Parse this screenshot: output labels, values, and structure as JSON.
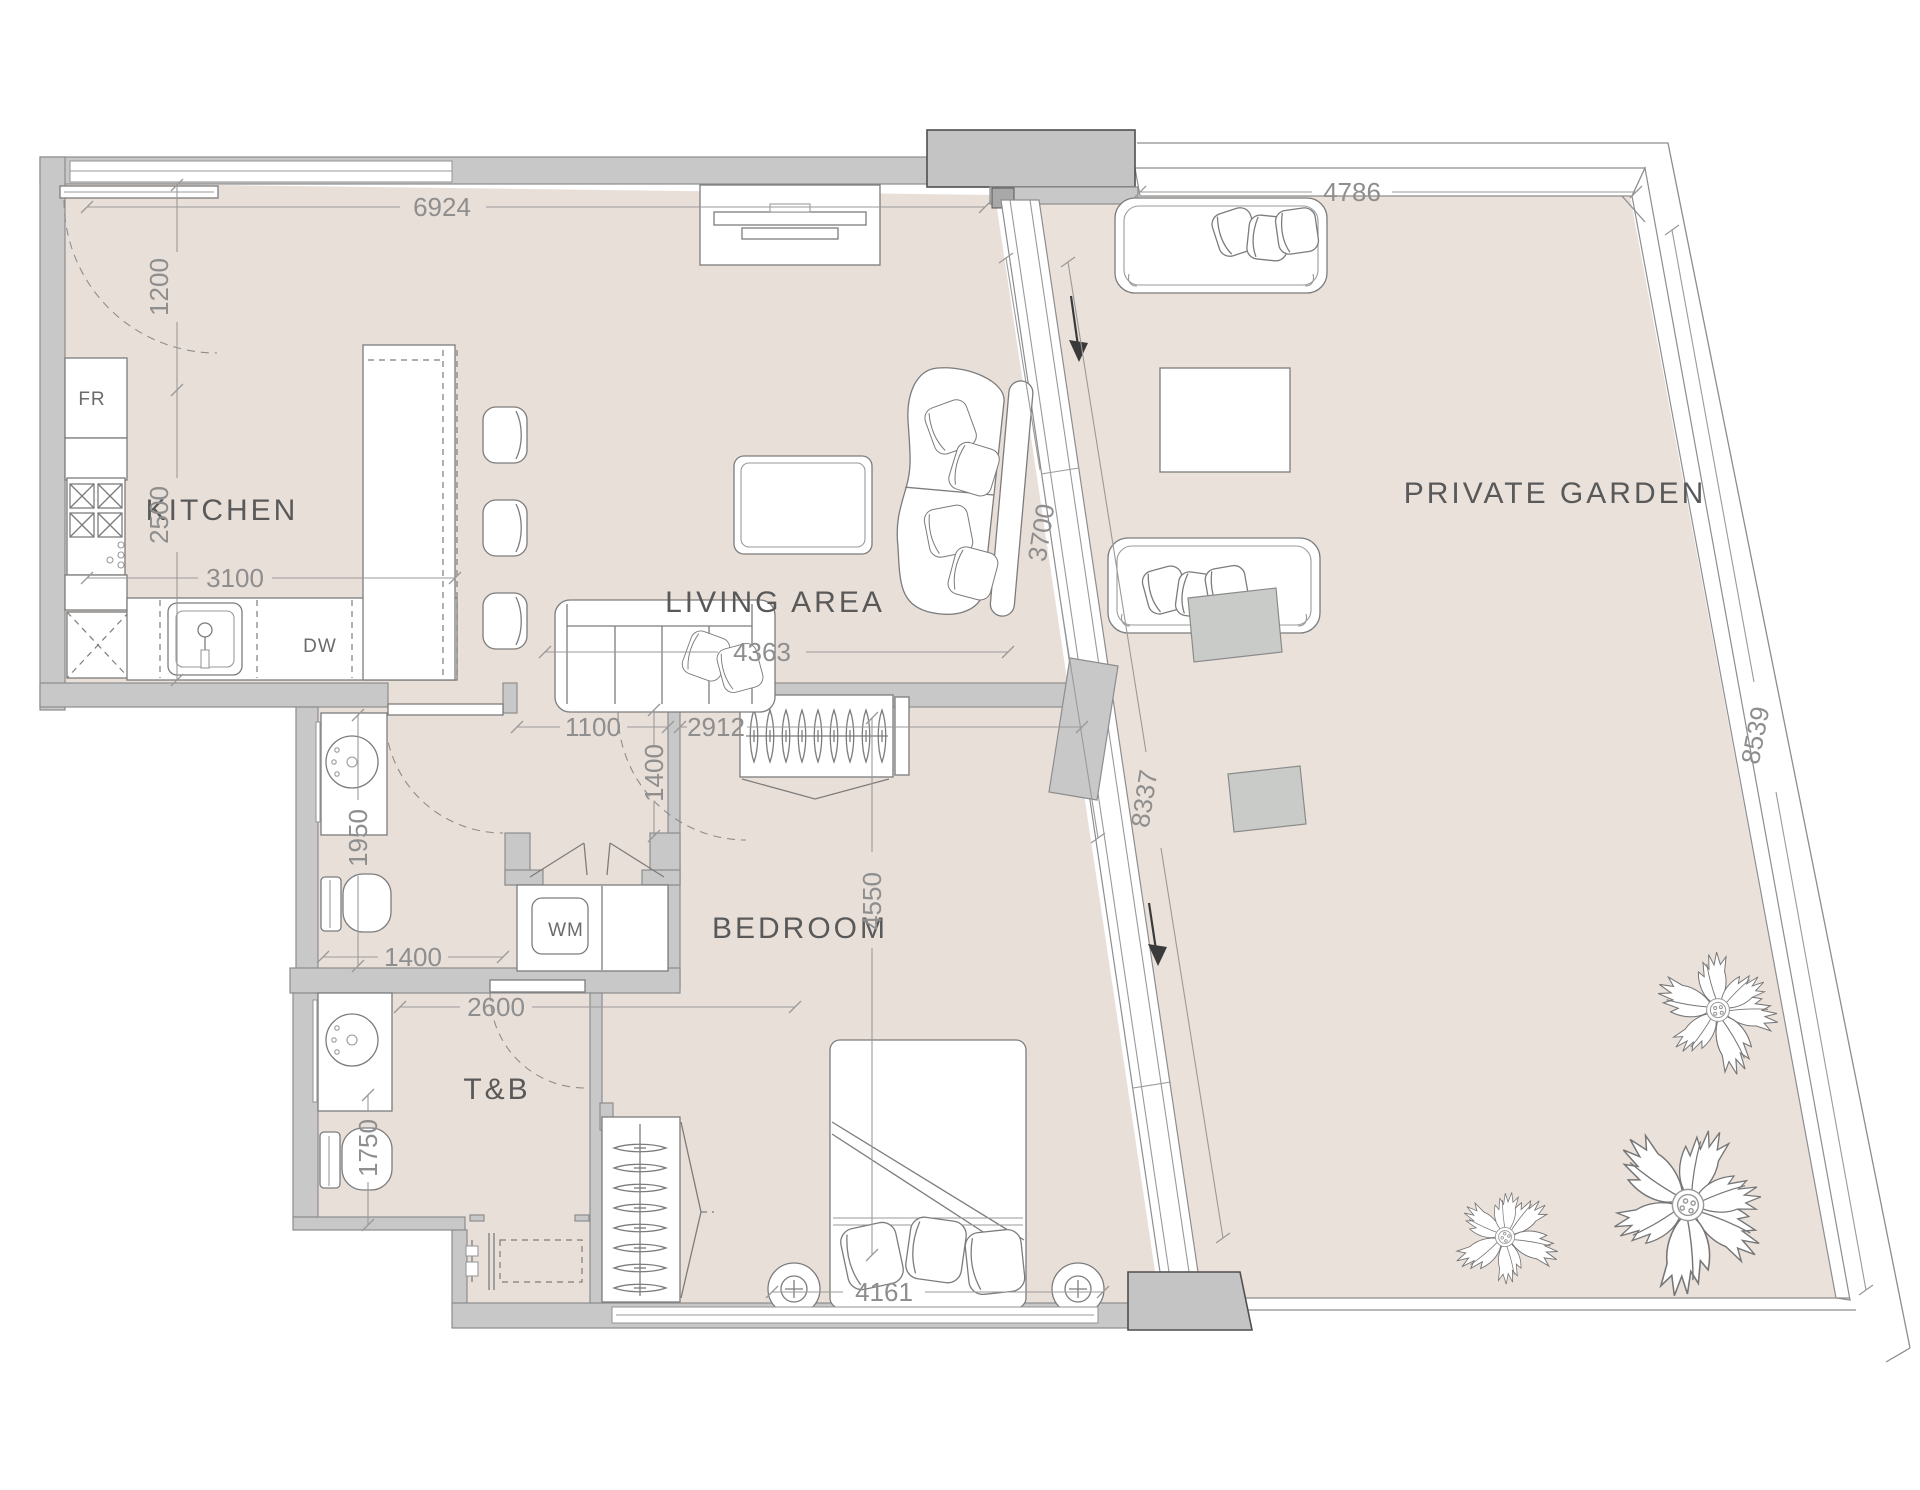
{
  "floorplan": {
    "type": "apartment-unit-floor-plan",
    "rooms": {
      "kitchen": "KITCHEN",
      "living": "LIVING AREA",
      "bedroom": "BEDROOM",
      "bath": "T&B",
      "garden": "PRIVATE GARDEN"
    },
    "appliances": {
      "fridge": "FR",
      "dishwasher": "DW",
      "washer": "WM"
    },
    "dimensions_mm": {
      "kitchen_living_top": "6924",
      "entry_opening": "1200",
      "kitchen_depth": "2500",
      "kitchen_width": "3100",
      "living_width": "4363",
      "living_depth": "3700",
      "garden_top": "4786",
      "window_wall": "8337",
      "garden_side": "8539",
      "hall_opening": "1100",
      "wardrobe_wall": "2912",
      "hall_depth": "1400",
      "powder_depth": "1950",
      "powder_width": "1400",
      "bath_width": "2600",
      "bath_depth": "1750",
      "bedroom_depth": "4550",
      "bedroom_width": "4161"
    },
    "colors": {
      "floor": "#e9dfd9",
      "garden_floor": "#eae1db",
      "wall": "#c8c8c8",
      "wall_outline": "#8d8d8d",
      "pillar": "#c4c4c4",
      "furniture_line": "#7c7c7c",
      "dimension_text": "#8e8e8e",
      "room_label": "#595959"
    }
  }
}
